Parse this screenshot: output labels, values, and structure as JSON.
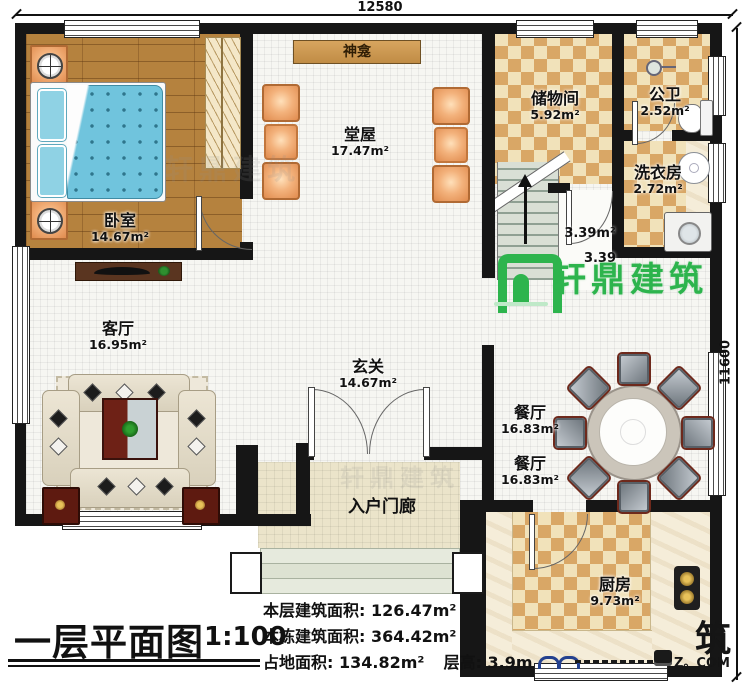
{
  "plan": {
    "dim_top": "12580",
    "dim_right": "11600",
    "rooms": {
      "bedroom": {
        "name": "卧室",
        "area": "14.67m²"
      },
      "hall": {
        "name": "堂屋",
        "area": "17.47m²"
      },
      "shrine": {
        "name": "神龛"
      },
      "storage": {
        "name": "储物间",
        "area": "5.92m²"
      },
      "bath": {
        "name": "公卫",
        "area": "2.52m²"
      },
      "laundry": {
        "name": "洗衣房",
        "area": "2.72m²"
      },
      "living": {
        "name": "客厅",
        "area": "16.95m²"
      },
      "foyer": {
        "name": "玄关",
        "area": "14.67m²"
      },
      "stair": {
        "area": "3.39m²",
        "area2": "3.39"
      },
      "dining": {
        "name": "餐厅",
        "area": "16.83m²"
      },
      "dining2": {
        "name": "餐厅",
        "area": "16.83m²"
      },
      "kitchen": {
        "name": "厨房",
        "area": "9.73m²"
      },
      "porch": {
        "name": "入户门廊"
      }
    },
    "dining_seats": 8
  },
  "title_block": {
    "title": "一层平面图",
    "scale": "1:100",
    "lines": [
      {
        "label": "本层建筑面积:",
        "value": "126.47m²"
      },
      {
        "label": "本栋建筑面积:",
        "value": "364.42m²"
      },
      {
        "label": "占地面积:",
        "value": "134.82m²",
        "label2": "层高:",
        "value2": "3.9m"
      }
    ]
  },
  "watermark": {
    "brand": "轩鼎建筑",
    "corner_mark": "筑",
    "corner_site": "Z。COM"
  },
  "colors": {
    "wall": "#161616",
    "brand_green": "#2db44d",
    "checker_dark": "#d9a766",
    "checker_light": "#f1e2ba",
    "wood": "#b5823e",
    "bed_blue": "#70c4dd"
  }
}
